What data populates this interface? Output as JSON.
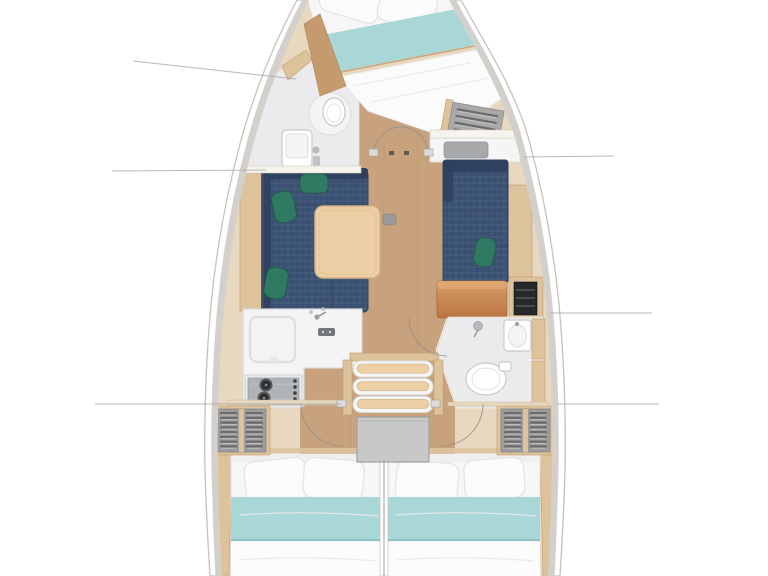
{
  "meta": {
    "kind": "sailing-yacht-interior-floor-plan",
    "view": "top-down, bow pointing up",
    "visible_text": "none"
  },
  "palette": {
    "hull_band": "#d3d0cc",
    "hull_line": "#c5c2be",
    "interior_base": "#e8d8c0",
    "floor_wood": "#c7a27c",
    "trim_wood": "#ddc39c",
    "trim_wood_dark": "#c49a6e",
    "wall_white": "#f7f4ee",
    "sofa_navy": "#3c5375",
    "sofa_navy_dark": "#2e415f",
    "cushion_green": "#2f7a63",
    "cushion_green_dark": "#1f5845",
    "table_wood": "#eccfa5",
    "table_edge": "#d2b184",
    "bed_white": "#fbfbfb",
    "bed_shadow": "#e6e6e6",
    "bed_teal": "#a9d7d8",
    "bed_teal_dark": "#8cc3c5",
    "bath_floor": "#ebebed",
    "fixture_line": "#c8c8cc",
    "locker_gray": "#9d9d9d",
    "locker_slat": "#6b6b6b",
    "locker_slat_light": "#c9c9c9",
    "stove_gray": "#b0b3b6",
    "burner_dark": "#2c2e30",
    "engine_gray": "#c8c8c8",
    "nav_orange": "#cd8a52",
    "nav_orange_dark": "#b06f3b",
    "panel_black": "#26282b",
    "door_arc": "#909090",
    "leader_line": "#a6a6a6"
  },
  "components": [
    "hull",
    "forward-cabin-bed",
    "forward-head",
    "forward-shelf-unit",
    "salon-sofa-port",
    "salon-table",
    "settee-starboard",
    "wet-bar-counter",
    "nav-station",
    "galley",
    "stove",
    "companionway-stairs",
    "engine-box",
    "aft-head",
    "aft-locker-port",
    "aft-locker-starboard",
    "aft-cabin-bed-port",
    "aft-cabin-bed-starboard",
    "cabin-doors",
    "leader-lines"
  ],
  "render": {
    "leader_lines": [
      [
        133,
        61,
        296,
        79
      ],
      [
        112,
        171,
        266,
        170
      ],
      [
        524,
        157,
        614,
        156
      ],
      [
        551,
        313,
        652,
        313
      ],
      [
        95,
        404,
        341,
        404
      ],
      [
        557,
        404,
        659,
        404
      ]
    ],
    "stair_steps": 3,
    "stove_burners": 2,
    "locker_slat_rows": 8,
    "shelf_slat_rows": 6,
    "aft_cabin_count": 2,
    "bathroom_count": 2
  }
}
